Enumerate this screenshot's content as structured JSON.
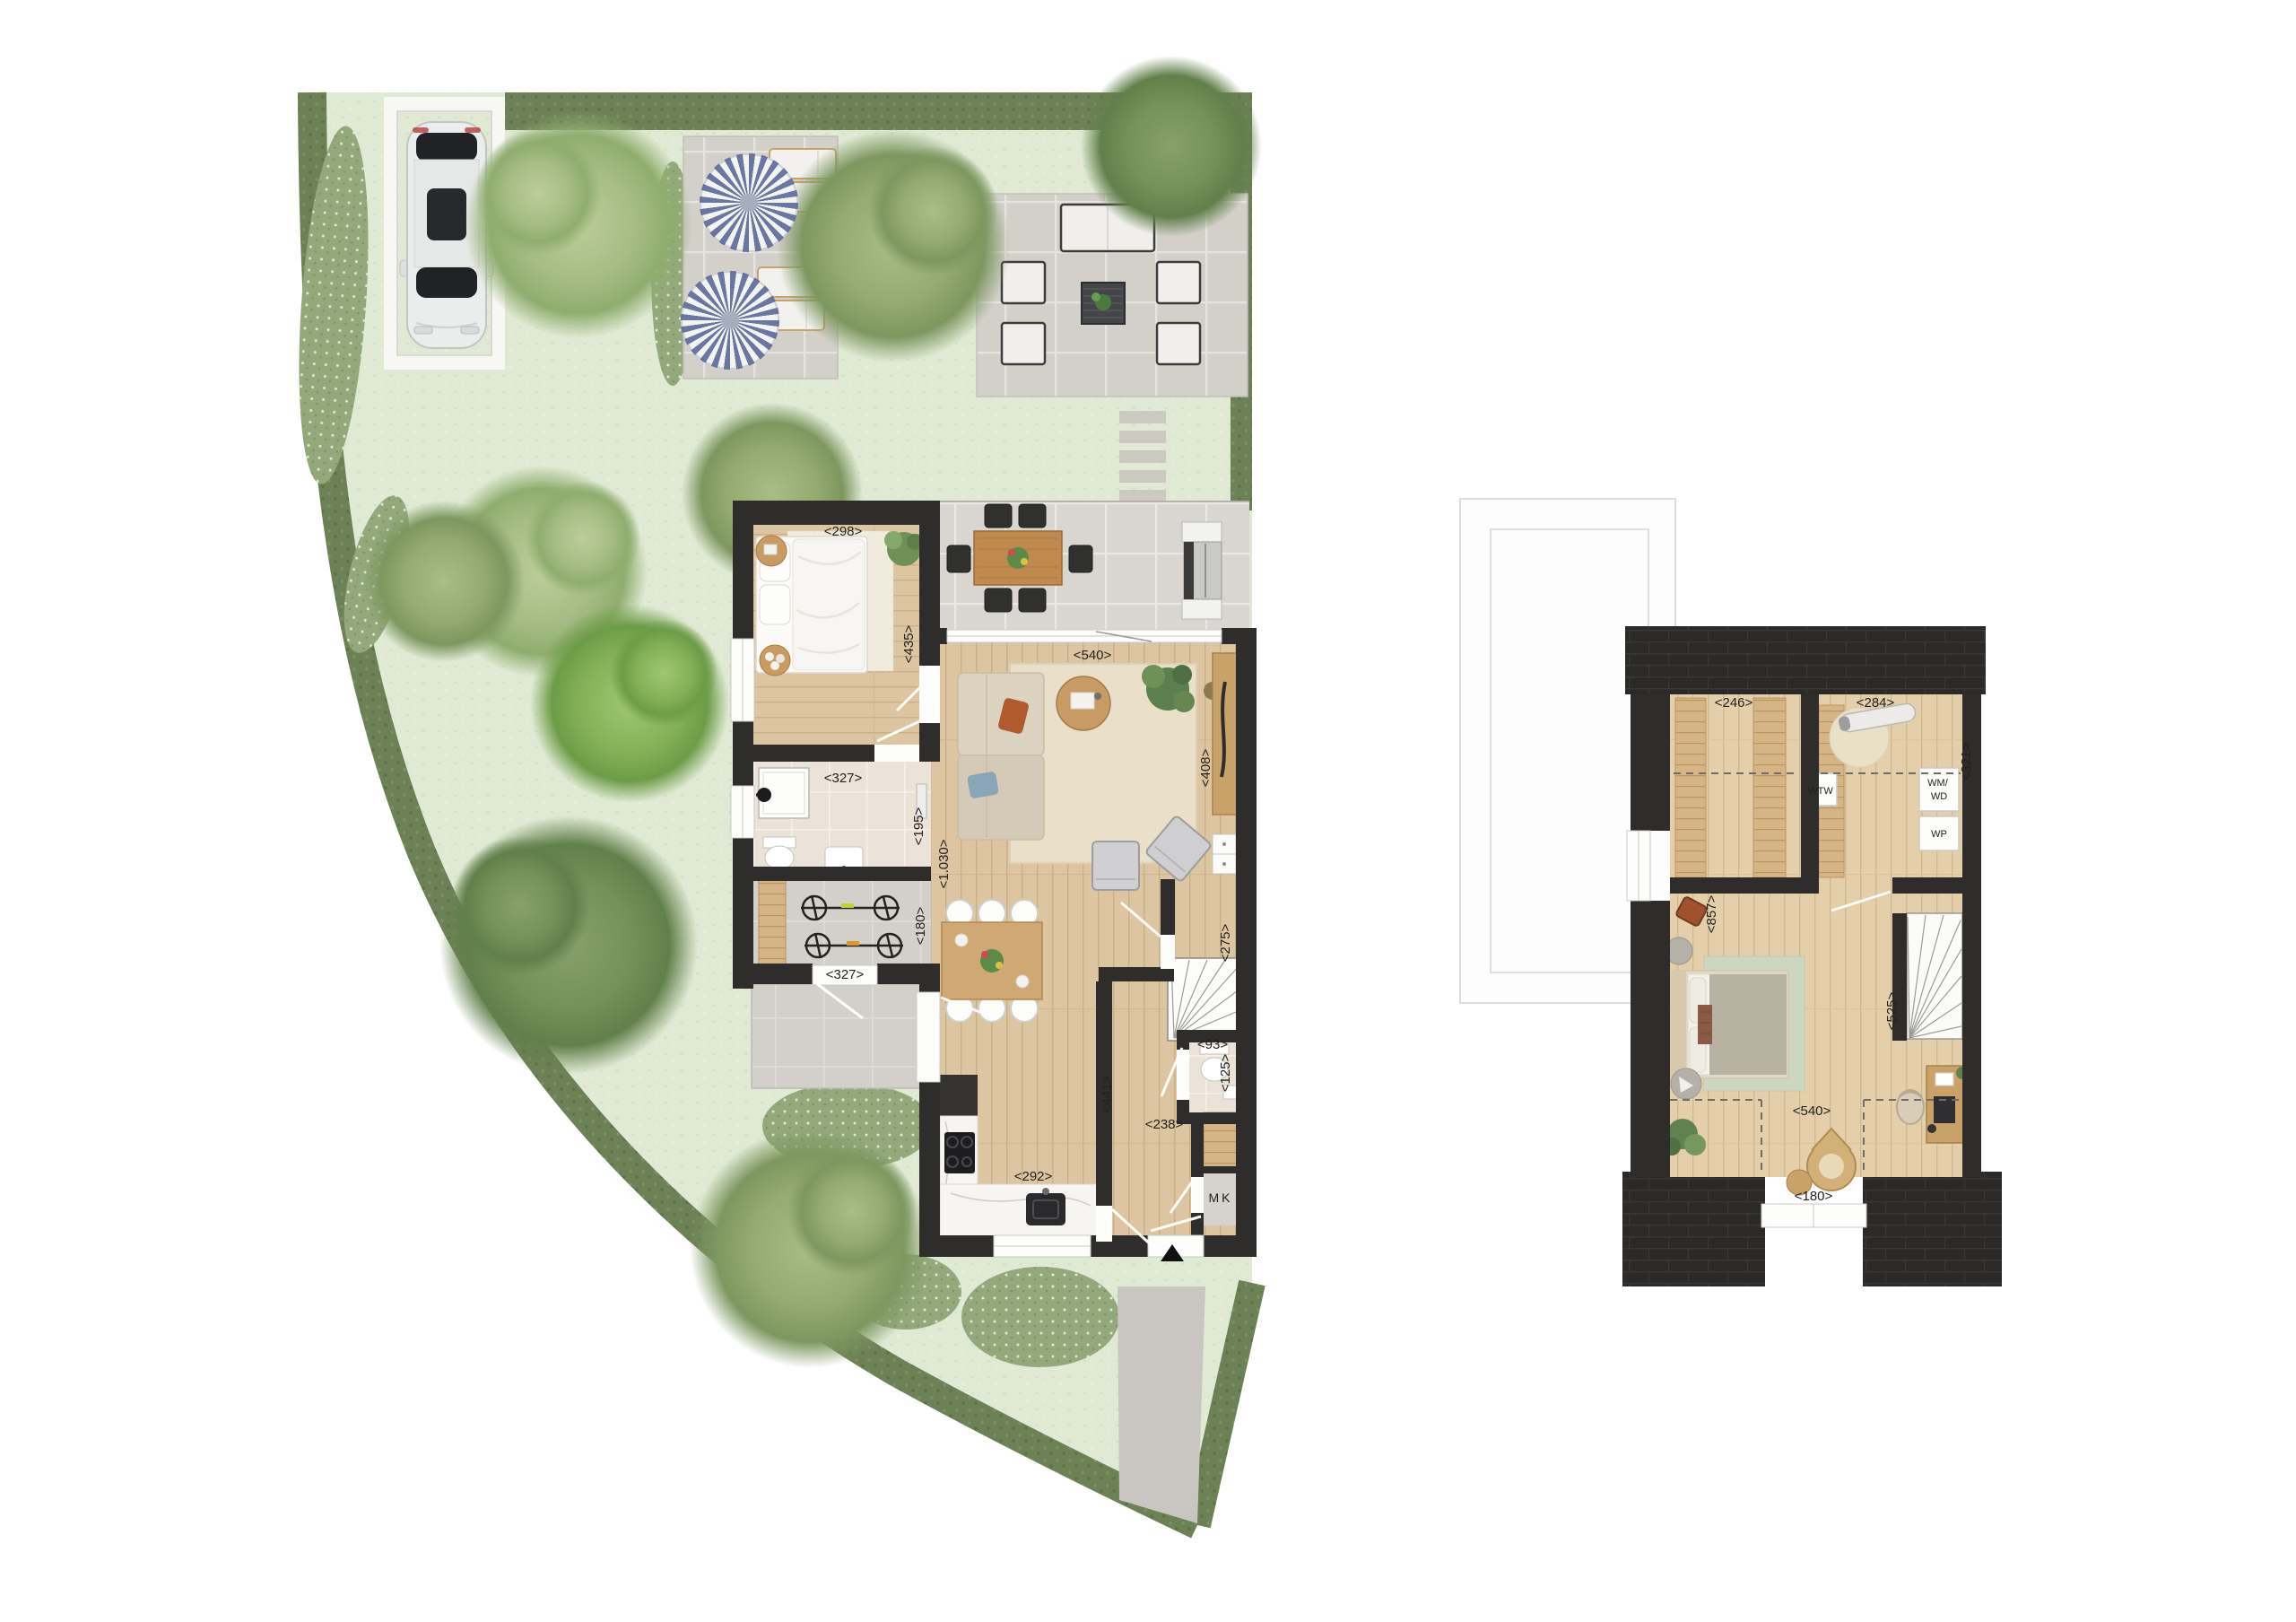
{
  "ground_floor": {
    "bedroom": {
      "width": "<298>",
      "depth": "<435>"
    },
    "terrace_doors": {
      "width": "<540>"
    },
    "living_room": {
      "depth": "<1.030>",
      "cabinet_wall": "<408>"
    },
    "hallway": {
      "upper_depth": "<275>",
      "depth": "<441>",
      "width": "<238>"
    },
    "bathroom": {
      "width": "<327>",
      "depth": "<195>"
    },
    "storage_room": {
      "width": "<327>",
      "depth": "<180>"
    },
    "kitchen": {
      "width": "<292>"
    },
    "toilet": {
      "width": "<93>",
      "depth": "<125>"
    },
    "meter_cupboard": {
      "label": "MK"
    }
  },
  "first_floor": {
    "storage_attic": {
      "width": "<246>"
    },
    "laundry_room": {
      "width": "<284>",
      "depth": "<321>"
    },
    "landing": {
      "depth": "<857>"
    },
    "bedroom": {
      "width": "<540>",
      "depth": "<525>"
    },
    "dormer_window": {
      "width": "<180>"
    },
    "appliances": {
      "wtw": "WTW",
      "wm_wd": [
        "WM/",
        "WD"
      ],
      "wp": "WP"
    }
  }
}
